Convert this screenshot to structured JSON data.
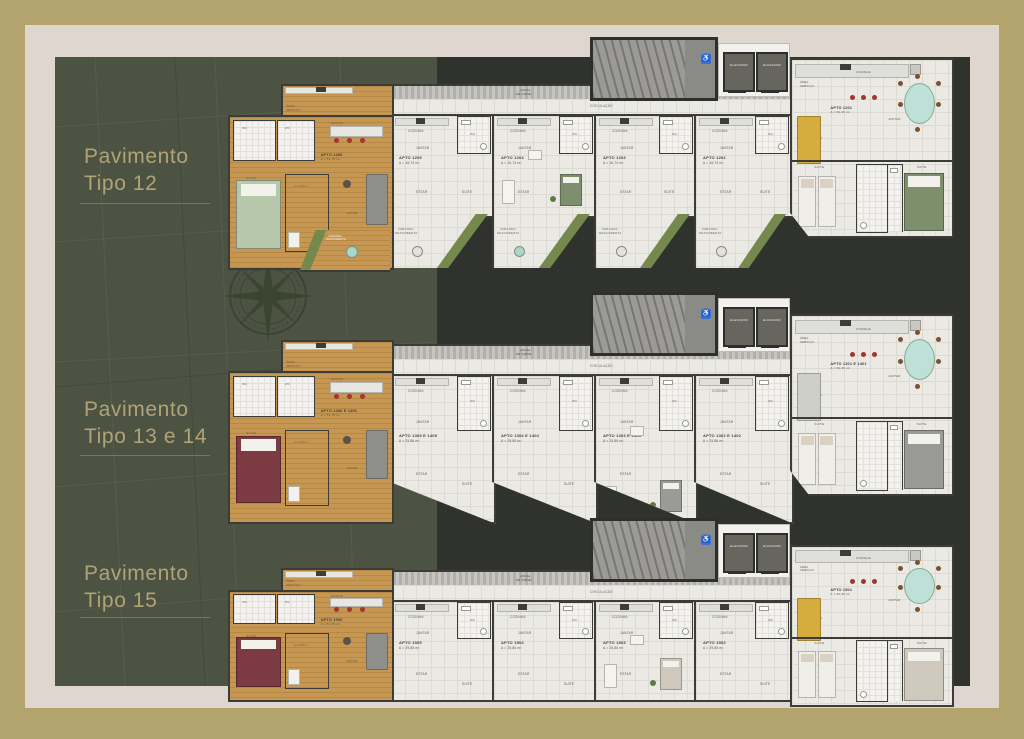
{
  "theme": {
    "frame_olive": "#b2a46c",
    "margin_cream": "#ded6cf",
    "panel_green": "#4c5342",
    "panel_charcoal": "#30322d",
    "title_khaki": "#b1a375",
    "wood_floor": "#c69753",
    "tile_floor": "#ebe9e4",
    "grass_green": "#75894f",
    "accent_teal": "#a9d7c8",
    "accent_red": "#8e3f46",
    "accent_yellow": "#d4ad3e",
    "accessibility_blue": "#3a6fd0"
  },
  "icons": {
    "compass": "compass-rose",
    "accessibility": "wheelchair"
  },
  "shared": {
    "local_ac_line1": "LOCAL",
    "local_ac_line2": "AR COND.",
    "circulacao": "CIRCULAÇÃO",
    "elevador": "ELEVADOR",
    "varanda_line1": "VARANDA",
    "varanda_line2": "DESCOBERTA",
    "rooms": {
      "cozinha": "COZINHA",
      "jantar": "JANTAR",
      "estar": "ESTAR",
      "suite": "SUITE",
      "wc": "WC",
      "quarto": "QUARTO",
      "area_servico_1": "ÁREA",
      "area_servico_2": "SERVIÇO"
    }
  },
  "plans": [
    {
      "title1": "Pavimento",
      "title2": "Tipo 12",
      "left_apartment": {
        "label": "APTO 1206",
        "area": "A = 51,75 m²"
      },
      "units": [
        {
          "label": "APTO 1205",
          "area": "A = 16,74 m²"
        },
        {
          "label": "APTO 1204",
          "area": "A = 16,74 m²"
        },
        {
          "label": "APTO 1203",
          "area": "A = 16,74 m²"
        },
        {
          "label": "APTO 1202",
          "area": "A = 16,74 m²"
        }
      ],
      "right_apartment": {
        "label": "APTO 1201",
        "area": "A = 52,36 m²"
      }
    },
    {
      "title1": "Pavimento",
      "title2": "Tipo 13 e 14",
      "left_apartment": {
        "label": "APTO 1306 E 1406",
        "area": "A = 51,75 m²"
      },
      "units": [
        {
          "label": "APTO 1305 E 1405",
          "area": "A = 25,86 m²"
        },
        {
          "label": "APTO 1304 E 1404",
          "area": "A = 25,86 m²"
        },
        {
          "label": "APTO 1303 E 1403",
          "area": "A = 25,86 m²"
        },
        {
          "label": "APTO 1302 E 1402",
          "area": "A = 25,86 m²"
        }
      ],
      "right_apartment": {
        "label": "APTO 1301 E 1401",
        "area": "A = 52,36 m²"
      }
    },
    {
      "title1": "Pavimento",
      "title2": "Tipo 15",
      "left_apartment": {
        "label": "APTO 1506",
        "area": "A = 51,75 m²"
      },
      "units": [
        {
          "label": "APTO 1505",
          "area": "A = 25,86 m²"
        },
        {
          "label": "APTO 1504",
          "area": "A = 25,86 m²"
        },
        {
          "label": "APTO 1503",
          "area": "A = 25,86 m²"
        },
        {
          "label": "APTO 1502",
          "area": "A = 25,86 m²"
        }
      ],
      "right_apartment": {
        "label": "APTO 1501",
        "area": "A = 52,36 m²"
      }
    }
  ]
}
